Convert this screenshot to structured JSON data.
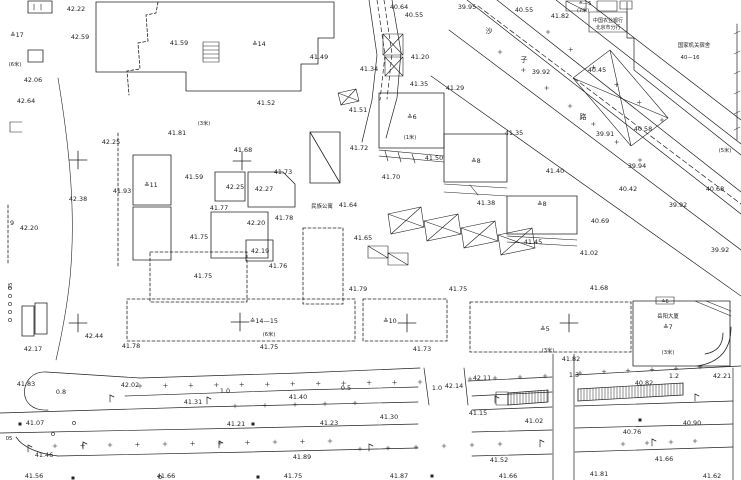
{
  "map": {
    "colors": {
      "ink": "#222222",
      "bg": "#ffffff"
    },
    "labels": [
      {
        "t": "42.22",
        "x": 76,
        "y": 11
      },
      {
        "t": "42.59",
        "x": 80,
        "y": 39
      },
      {
        "t": "≙17",
        "x": 17,
        "y": 37
      },
      {
        "t": "(6米)",
        "x": 15,
        "y": 66,
        "s": 5.2
      },
      {
        "t": "42.06",
        "x": 33,
        "y": 82
      },
      {
        "t": "42.64",
        "x": 26,
        "y": 103
      },
      {
        "t": "41.59",
        "x": 179,
        "y": 45
      },
      {
        "t": "≙14",
        "x": 259,
        "y": 46
      },
      {
        "t": "41.49",
        "x": 319,
        "y": 59
      },
      {
        "t": "41.52",
        "x": 266,
        "y": 105
      },
      {
        "t": "41.51",
        "x": 358,
        "y": 112
      },
      {
        "t": "40.64",
        "x": 399,
        "y": 9
      },
      {
        "t": "40.55",
        "x": 414,
        "y": 17
      },
      {
        "t": "41.34",
        "x": 369,
        "y": 71
      },
      {
        "t": "41.20",
        "x": 420,
        "y": 59
      },
      {
        "t": "41.35",
        "x": 419,
        "y": 86
      },
      {
        "t": "41.29",
        "x": 455,
        "y": 90
      },
      {
        "t": "39.95",
        "x": 467,
        "y": 9
      },
      {
        "t": "40.55",
        "x": 524,
        "y": 12
      },
      {
        "t": "41.82",
        "x": 560,
        "y": 18
      },
      {
        "t": "≙—5",
        "x": 585,
        "y": 5,
        "s": 5.2
      },
      {
        "t": "(7米)",
        "x": 583,
        "y": 12,
        "s": 5
      },
      {
        "t": "中国农业银行",
        "x": 608,
        "y": 22,
        "s": 5
      },
      {
        "t": "北京市分行",
        "x": 608,
        "y": 29,
        "s": 5
      },
      {
        "t": "国家机关宿舍",
        "x": 694,
        "y": 47,
        "s": 5.4
      },
      {
        "t": "40—16",
        "x": 690,
        "y": 59,
        "s": 5.4
      },
      {
        "t": "40.45",
        "x": 597,
        "y": 72
      },
      {
        "t": "39.92",
        "x": 541,
        "y": 74
      },
      {
        "t": "沙",
        "x": 489,
        "y": 33,
        "s": 7
      },
      {
        "t": "子",
        "x": 524,
        "y": 62,
        "s": 7
      },
      {
        "t": "路",
        "x": 583,
        "y": 119,
        "s": 7
      },
      {
        "t": "39.91",
        "x": 605,
        "y": 136
      },
      {
        "t": "40.58",
        "x": 643,
        "y": 131
      },
      {
        "t": "(5米)",
        "x": 725,
        "y": 152,
        "s": 5.2
      },
      {
        "t": "39.94",
        "x": 637,
        "y": 168
      },
      {
        "t": "40.42",
        "x": 628,
        "y": 191
      },
      {
        "t": "40.68",
        "x": 715,
        "y": 191
      },
      {
        "t": "39.92",
        "x": 678,
        "y": 207
      },
      {
        "t": "40.69",
        "x": 600,
        "y": 223
      },
      {
        "t": "39.92",
        "x": 720,
        "y": 252
      },
      {
        "t": "42.25",
        "x": 111,
        "y": 144
      },
      {
        "t": "41.81",
        "x": 177,
        "y": 135
      },
      {
        "t": "(3米)",
        "x": 204,
        "y": 125,
        "s": 5.2
      },
      {
        "t": "41.93",
        "x": 122,
        "y": 193
      },
      {
        "t": "≙11",
        "x": 151,
        "y": 187
      },
      {
        "t": "42.38",
        "x": 78,
        "y": 201
      },
      {
        "t": "42.20",
        "x": 29,
        "y": 230
      },
      {
        "t": "9",
        "x": 12,
        "y": 225
      },
      {
        "t": "41.59",
        "x": 194,
        "y": 179
      },
      {
        "t": "42.25",
        "x": 235,
        "y": 189
      },
      {
        "t": "42.27",
        "x": 264,
        "y": 191
      },
      {
        "t": "41.68",
        "x": 243,
        "y": 152
      },
      {
        "t": "41.73",
        "x": 283,
        "y": 174
      },
      {
        "t": "41.77",
        "x": 219,
        "y": 210
      },
      {
        "t": "42.20",
        "x": 256,
        "y": 225
      },
      {
        "t": "41.78",
        "x": 284,
        "y": 220
      },
      {
        "t": "41.75",
        "x": 199,
        "y": 239
      },
      {
        "t": "42.19",
        "x": 260,
        "y": 253
      },
      {
        "t": "41.76",
        "x": 278,
        "y": 268
      },
      {
        "t": "41.75",
        "x": 203,
        "y": 278
      },
      {
        "t": "41.72",
        "x": 359,
        "y": 150
      },
      {
        "t": "民族公寓",
        "x": 322,
        "y": 208,
        "s": 5.4
      },
      {
        "t": "41.64",
        "x": 348,
        "y": 207
      },
      {
        "t": "41.65",
        "x": 363,
        "y": 240
      },
      {
        "t": "41.70",
        "x": 391,
        "y": 179
      },
      {
        "t": "41.50",
        "x": 434,
        "y": 160
      },
      {
        "t": "(1米)",
        "x": 410,
        "y": 139,
        "s": 5.2
      },
      {
        "t": "≙6",
        "x": 412,
        "y": 119
      },
      {
        "t": "≙8",
        "x": 476,
        "y": 163
      },
      {
        "t": "41.35",
        "x": 514,
        "y": 135
      },
      {
        "t": "41.40",
        "x": 555,
        "y": 173
      },
      {
        "t": "41.38",
        "x": 486,
        "y": 205
      },
      {
        "t": "≙8",
        "x": 542,
        "y": 206
      },
      {
        "t": "41.45",
        "x": 533,
        "y": 244
      },
      {
        "t": "41.02",
        "x": 589,
        "y": 255
      },
      {
        "t": "41.75",
        "x": 458,
        "y": 291
      },
      {
        "t": "41.68",
        "x": 599,
        "y": 290
      },
      {
        "t": "41.79",
        "x": 358,
        "y": 291
      },
      {
        "t": "75",
        "x": 12,
        "y": 286,
        "r": -90,
        "s": 5.4
      },
      {
        "t": "42.44",
        "x": 94,
        "y": 338
      },
      {
        "t": "42.17",
        "x": 33,
        "y": 351
      },
      {
        "t": "41.78",
        "x": 131,
        "y": 348
      },
      {
        "t": "41.83",
        "x": 26,
        "y": 386
      },
      {
        "t": "42.02",
        "x": 130,
        "y": 387
      },
      {
        "t": "0.8",
        "x": 61,
        "y": 394
      },
      {
        "t": "1.0",
        "x": 225,
        "y": 393
      },
      {
        "t": "≙14—15",
        "x": 264,
        "y": 323
      },
      {
        "t": "(6米)",
        "x": 269,
        "y": 336,
        "s": 5.2
      },
      {
        "t": "41.75",
        "x": 269,
        "y": 349
      },
      {
        "t": "≙10",
        "x": 390,
        "y": 323
      },
      {
        "t": "41.73",
        "x": 422,
        "y": 351
      },
      {
        "t": "0.5",
        "x": 346,
        "y": 390
      },
      {
        "t": "41.40",
        "x": 298,
        "y": 399
      },
      {
        "t": "1.0",
        "x": 437,
        "y": 390
      },
      {
        "t": "42.14",
        "x": 454,
        "y": 388
      },
      {
        "t": "42.11",
        "x": 482,
        "y": 380
      },
      {
        "t": "≙5",
        "x": 545,
        "y": 331
      },
      {
        "t": "(3米)",
        "x": 548,
        "y": 352,
        "s": 5.2
      },
      {
        "t": "41.82",
        "x": 571,
        "y": 361
      },
      {
        "t": "1.3",
        "x": 574,
        "y": 377
      },
      {
        "t": "40.82",
        "x": 644,
        "y": 385
      },
      {
        "t": "≙6",
        "x": 665,
        "y": 303,
        "s": 5
      },
      {
        "t": "岳阳大厦",
        "x": 668,
        "y": 318,
        "s": 5.4
      },
      {
        "t": "≙7",
        "x": 668,
        "y": 329
      },
      {
        "t": "(3米)",
        "x": 668,
        "y": 354,
        "s": 5.2
      },
      {
        "t": "1.2",
        "x": 674,
        "y": 378
      },
      {
        "t": "42.21",
        "x": 722,
        "y": 378
      },
      {
        "t": "41.31",
        "x": 193,
        "y": 404
      },
      {
        "t": "41.07",
        "x": 35,
        "y": 425
      },
      {
        "t": "41.21",
        "x": 236,
        "y": 426
      },
      {
        "t": "41.23",
        "x": 329,
        "y": 425
      },
      {
        "t": "41.30",
        "x": 389,
        "y": 419
      },
      {
        "t": "41.15",
        "x": 478,
        "y": 415
      },
      {
        "t": "41.02",
        "x": 534,
        "y": 423
      },
      {
        "t": "40.90",
        "x": 692,
        "y": 425
      },
      {
        "t": "40.76",
        "x": 632,
        "y": 434
      },
      {
        "t": "05",
        "x": 9,
        "y": 440,
        "s": 5.4
      },
      {
        "t": "41.46",
        "x": 44,
        "y": 457
      },
      {
        "t": "41.89",
        "x": 302,
        "y": 459
      },
      {
        "t": "41.52",
        "x": 499,
        "y": 462
      },
      {
        "t": "41.66",
        "x": 664,
        "y": 461
      },
      {
        "t": "41.56",
        "x": 34,
        "y": 478
      },
      {
        "t": "41.66",
        "x": 166,
        "y": 478
      },
      {
        "t": "41.75",
        "x": 293,
        "y": 478
      },
      {
        "t": "41.87",
        "x": 399,
        "y": 478
      },
      {
        "t": "41.66",
        "x": 508,
        "y": 478
      },
      {
        "t": "41.81",
        "x": 599,
        "y": 476
      },
      {
        "t": "41.62",
        "x": 712,
        "y": 478
      }
    ],
    "crosses": [
      [
        78,
        160
      ],
      [
        242,
        161
      ],
      [
        78,
        323
      ],
      [
        240,
        322
      ],
      [
        407,
        323
      ],
      [
        569,
        323
      ]
    ],
    "lamps": [
      [
        110,
        402
      ],
      [
        207,
        404
      ],
      [
        83,
        449
      ],
      [
        219,
        448
      ],
      [
        369,
        451
      ],
      [
        495,
        403
      ],
      [
        695,
        401
      ],
      [
        652,
        446
      ],
      [
        540,
        447
      ],
      [
        28,
        452
      ]
    ],
    "squares": [
      [
        20,
        424
      ],
      [
        253,
        424
      ],
      [
        258,
        477
      ],
      [
        640,
        420
      ],
      [
        432,
        476
      ],
      [
        73,
        478
      ]
    ],
    "circles": [
      [
        74,
        423
      ],
      [
        53,
        434
      ],
      [
        10,
        288
      ],
      [
        10,
        296
      ],
      [
        10,
        304
      ],
      [
        10,
        312
      ],
      [
        10,
        320
      ],
      [
        160,
        477
      ]
    ],
    "tick_rows": [
      {
        "x1": 140,
        "y1": 386,
        "x2": 420,
        "y2": 382,
        "n": 12
      },
      {
        "x1": 470,
        "y1": 379,
        "x2": 545,
        "y2": 376,
        "n": 4
      },
      {
        "x1": 580,
        "y1": 373,
        "x2": 700,
        "y2": 367,
        "n": 6
      },
      {
        "x1": 55,
        "y1": 446,
        "x2": 330,
        "y2": 441,
        "n": 11
      },
      {
        "x1": 360,
        "y1": 449,
        "x2": 500,
        "y2": 444,
        "n": 6
      },
      {
        "x1": 623,
        "y1": 444,
        "x2": 695,
        "y2": 441,
        "n": 4
      },
      {
        "x1": 235,
        "y1": 406,
        "x2": 355,
        "y2": 403,
        "n": 5
      },
      {
        "x1": 500,
        "y1": 52,
        "x2": 640,
        "y2": 160,
        "n": 7
      },
      {
        "x1": 548,
        "y1": 32,
        "x2": 662,
        "y2": 120,
        "n": 6
      }
    ],
    "hatch_bands": [
      {
        "x1": 508,
        "y1t": 393,
        "y1b": 405,
        "x2": 548,
        "y2t": 390,
        "y2b": 402,
        "step": 3
      },
      {
        "x1": 578,
        "y1t": 389,
        "y1b": 401,
        "x2": 683,
        "y2t": 383,
        "y2b": 395,
        "step": 3
      }
    ]
  }
}
